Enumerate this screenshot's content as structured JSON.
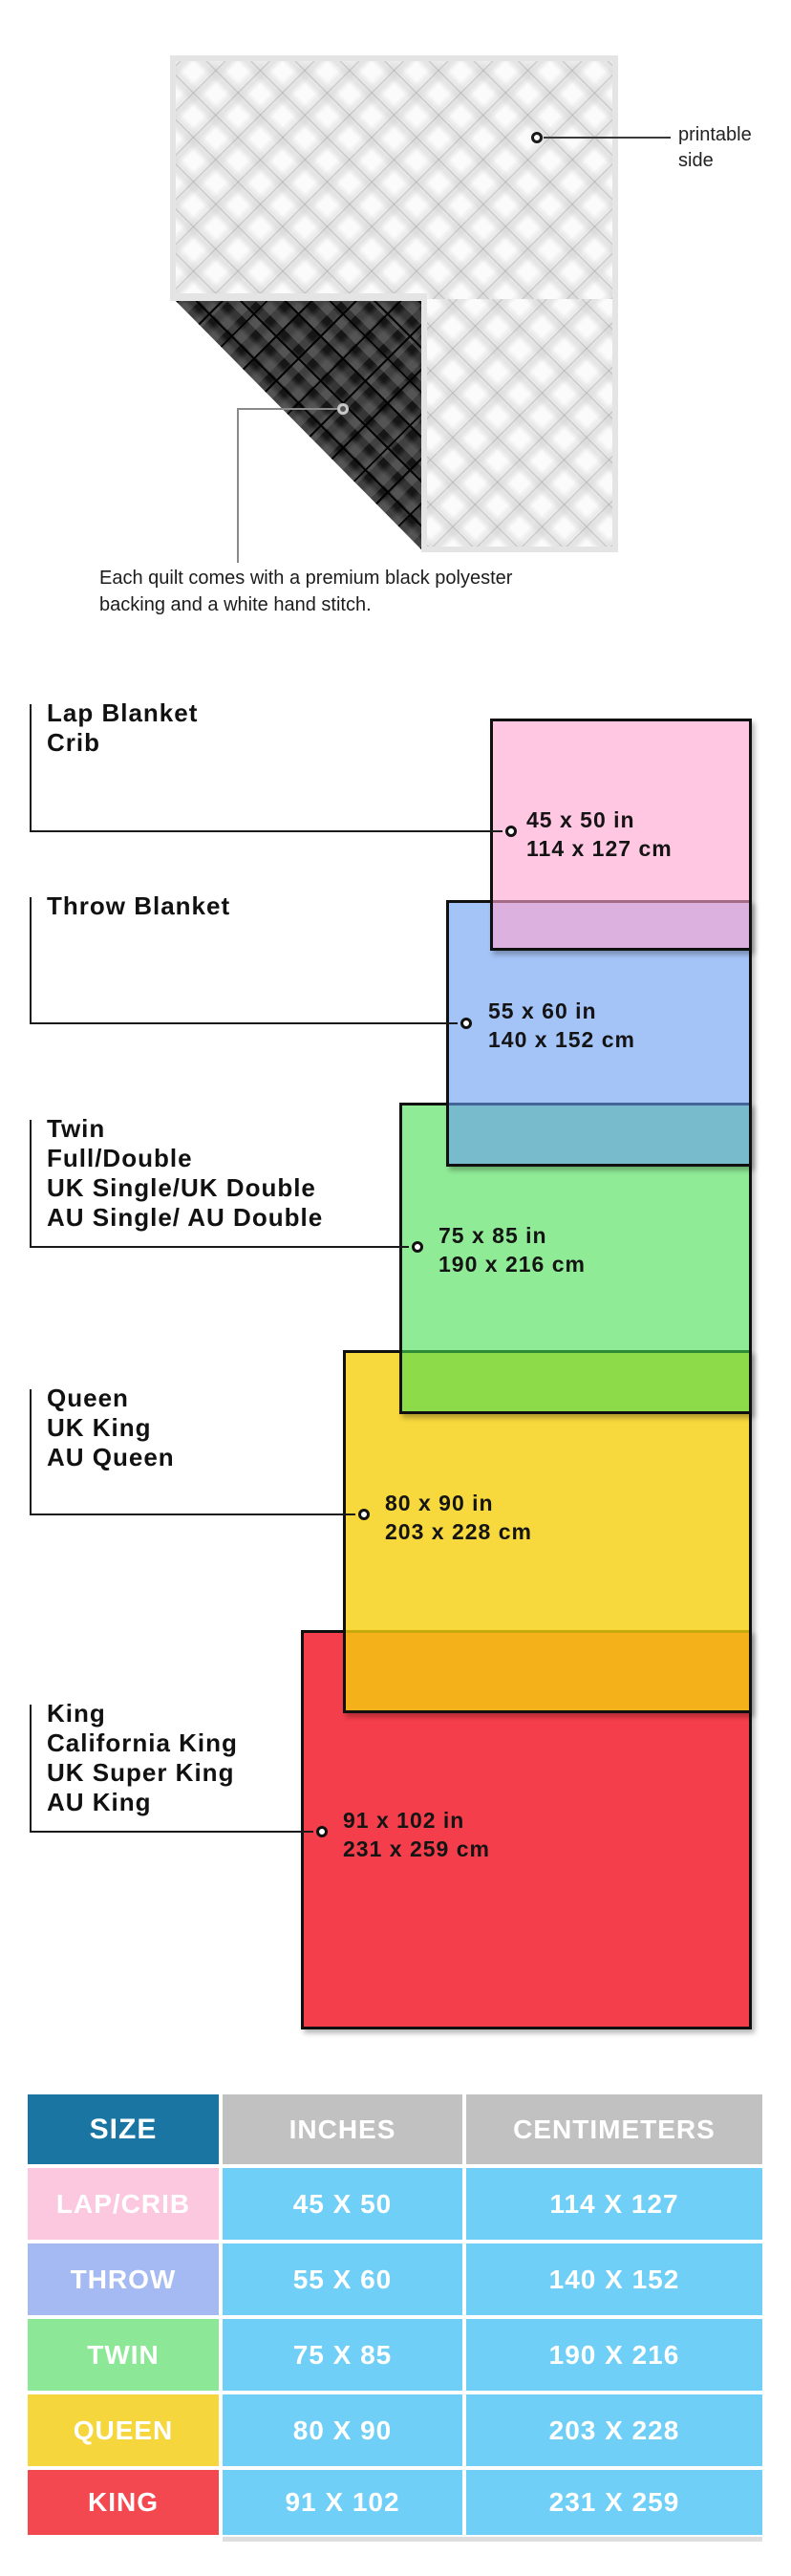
{
  "hero": {
    "printable_label_line1": "printable",
    "printable_label_line2": "side",
    "caption_line1": "Each quilt comes with a premium black polyester",
    "caption_line2": "backing and a white hand stitch.",
    "front_color": "#fbfbfb",
    "back_color": "#161616"
  },
  "diagram": {
    "sizes": [
      {
        "id": "lap",
        "labels": [
          "Lap Blanket",
          "Crib"
        ],
        "inches": "45 x 50 in",
        "cm": "114 x 127 cm",
        "fill": "rgba(255,165,208,0.62)",
        "color": "#FFC9E3"
      },
      {
        "id": "throw",
        "labels": [
          "Throw Blanket"
        ],
        "inches": "55 x 60 in",
        "cm": "140 x 152 cm",
        "fill": "rgba(103,155,242,0.60)",
        "color": "#A5C2F5"
      },
      {
        "id": "twin",
        "labels": [
          "Twin",
          "Full/Double",
          "UK Single/UK Double",
          "AU Single/ AU Double"
        ],
        "inches": "75 x 85 in",
        "cm": "190 x 216 cm",
        "fill": "rgba(70,222,80,0.60)",
        "color": "#96EBA0"
      },
      {
        "id": "queen",
        "labels": [
          "Queen",
          "UK King",
          "AU Queen"
        ],
        "inches": "80 x 90 in",
        "cm": "203 x 228 cm",
        "fill": "rgba(245,206,13,0.80)",
        "color": "#F6DB4A"
      },
      {
        "id": "king",
        "labels": [
          "King",
          "California King",
          "UK Super King",
          "AU King"
        ],
        "inches": "91 x 102 in",
        "cm": "231 x 259 cm",
        "fill": "rgba(241,20,35,0.82)",
        "color": "#F44752"
      }
    ]
  },
  "table": {
    "headers": [
      "SIZE",
      "INCHES",
      "CENTIMETERS"
    ],
    "header_size_color": "#1A75A3",
    "header_measure_color": "#C1C1C1",
    "value_cell_color": "#6FCFF7",
    "rows": [
      {
        "size": "LAP/CRIB",
        "inches": "45 X 50",
        "cm": "114 X 127",
        "color": "#FBC8E0"
      },
      {
        "size": "THROW",
        "inches": "55 X 60",
        "cm": "140 X 152",
        "color": "#A5BAF2"
      },
      {
        "size": "TWIN",
        "inches": "75 X 85",
        "cm": "190 X 216",
        "color": "#8CE896"
      },
      {
        "size": "QUEEN",
        "inches": "80 X 90",
        "cm": "203 X 228",
        "color": "#F5D63C"
      },
      {
        "size": "KING",
        "inches": "91 X 102",
        "cm": "231 X 259",
        "color": "#F44850"
      }
    ]
  }
}
